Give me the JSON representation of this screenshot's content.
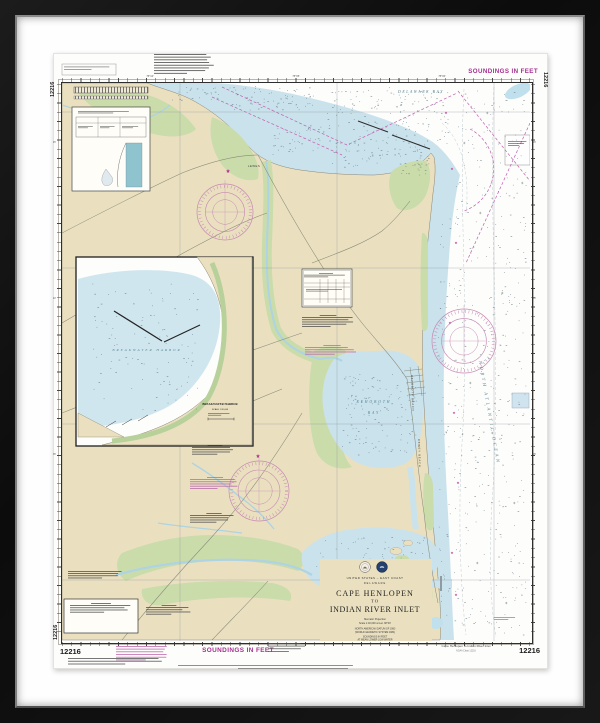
{
  "chart": {
    "number": "12216",
    "soundings_note": "SOUNDINGS IN FEET"
  },
  "margins": {
    "top_right_soundings": "SOUNDINGS IN FEET",
    "bottom_soundings": "SOUNDINGS IN FEET",
    "corner_numbers": {
      "top_left": "12216",
      "top_right": "12216",
      "bottom_left_edge": "12216",
      "bottom_left": "12216",
      "bottom_right": "12216"
    },
    "bottom_right_title": "Cape Henlopen to Indian River Inlet",
    "bottom_right_subtitle": "NOAA Chart 12216",
    "lon_labels": [
      "75°10'",
      "75°05'",
      "75°00'"
    ],
    "lat_labels": [
      "45'",
      "40'",
      "35'"
    ]
  },
  "title_block": {
    "region": "UNITED STATES – EAST COAST",
    "state": "DELAWARE",
    "title_line1": "CAPE HENLOPEN",
    "title_line2": "TO",
    "title_line3": "INDIAN RIVER INLET",
    "projection": "Mercator Projection",
    "scale": "Scale 1:40,000 at Lat. 38°40'",
    "datum_line1": "NORTH AMERICAN DATUM OF 1983",
    "datum_line2": "(WORLD GEODETIC SYSTEM 1984)",
    "soundings_line1": "SOUNDINGS IN FEET",
    "soundings_line2": "AT MEAN LOWER LOW WATER"
  },
  "map_labels": {
    "delaware_bay": "DELAWARE BAY",
    "north_atlantic_ocean": "NORTH ATLANTIC OCEAN",
    "rehoboth": "REHOBOTH",
    "bay": "BAY",
    "indian_river_bay": "INDIAN RIVER BAY",
    "lewes": "LEWES",
    "rehoboth_beach": "REHOBOTH BEACH",
    "dewey_beach": "DEWEY BEACH",
    "indian_river_inlet": "Indian River Inlet"
  },
  "inset": {
    "water_label": "BREAKWATER HARBOR",
    "title": "BREAKWATER HARBOR",
    "scale": "SCALE 1:20,000"
  },
  "colors": {
    "land": "#eae0c0",
    "marsh": "#cbdcab",
    "shallow_water": "#c9e2ec",
    "deep_water": "#fdfdfc",
    "magenta": "#b23a93",
    "frame": "#121212"
  }
}
